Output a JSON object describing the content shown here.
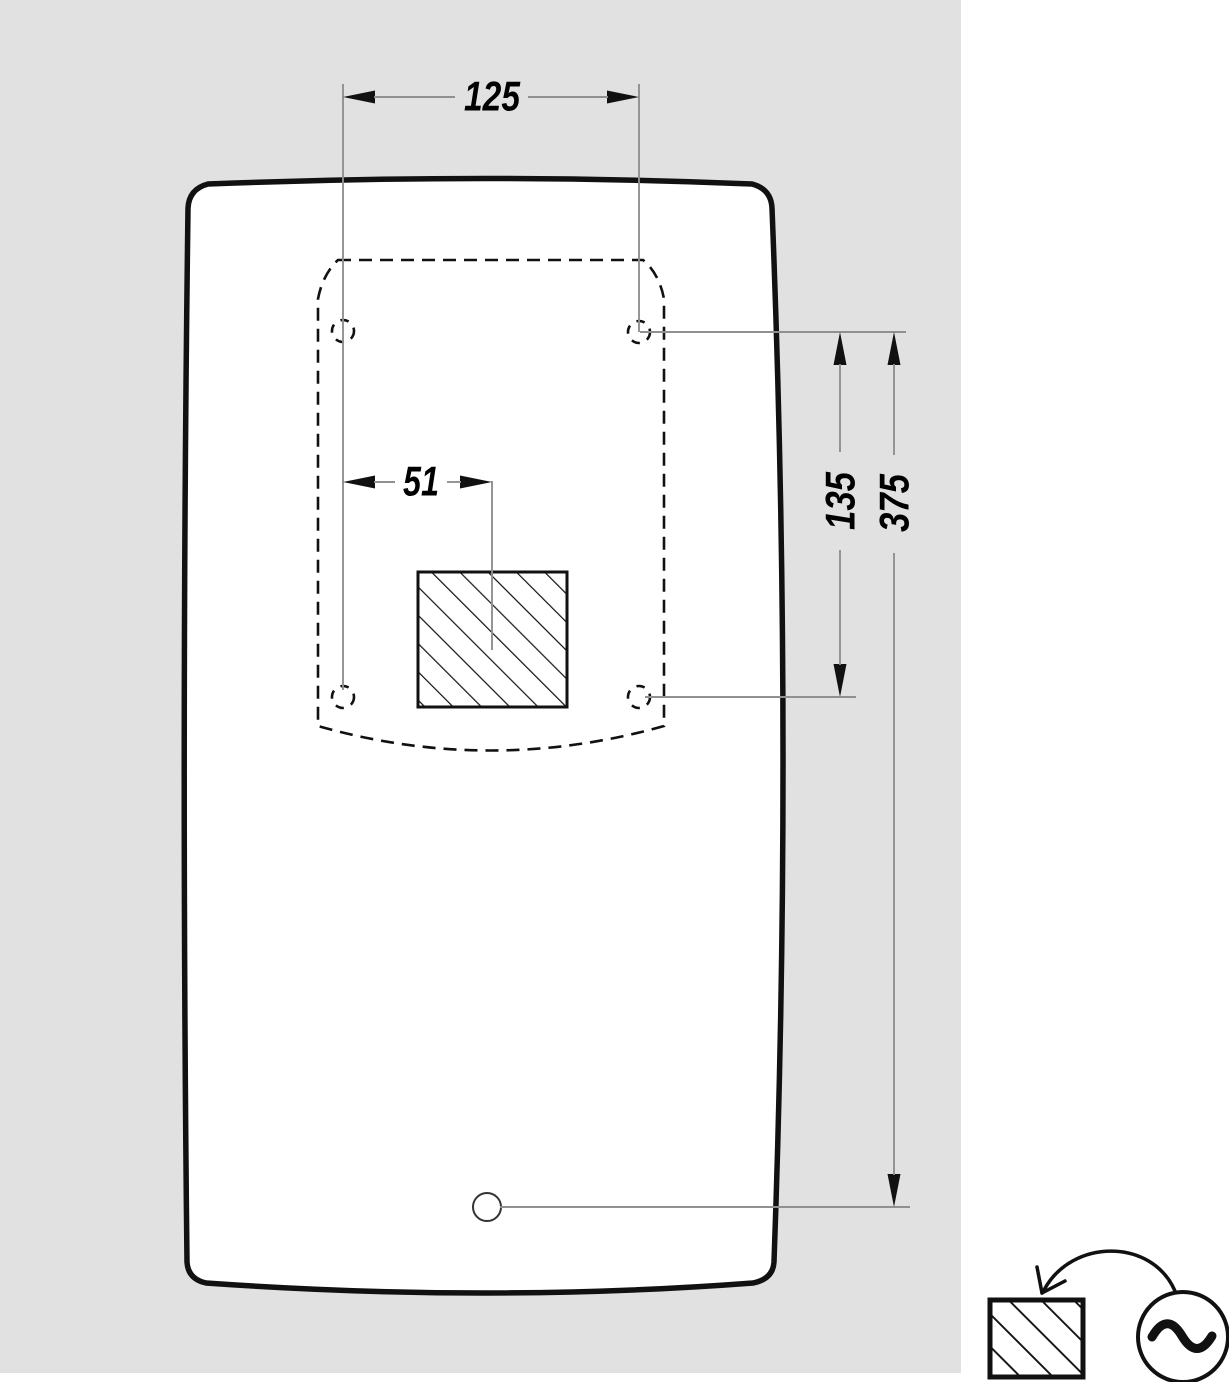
{
  "drawing": {
    "dimensions": {
      "horizontal_top": "125",
      "horizontal_center": "51",
      "vertical_inner": "135",
      "vertical_outer": "375"
    },
    "colors": {
      "page_background": "#ffffff",
      "panel_background": "#e1e1e1",
      "line": "#111111",
      "dimension_line": "#909090"
    },
    "legend": {
      "icons": [
        "hatched-area-icon",
        "curved-arrow-icon",
        "ac-source-icon"
      ]
    }
  }
}
